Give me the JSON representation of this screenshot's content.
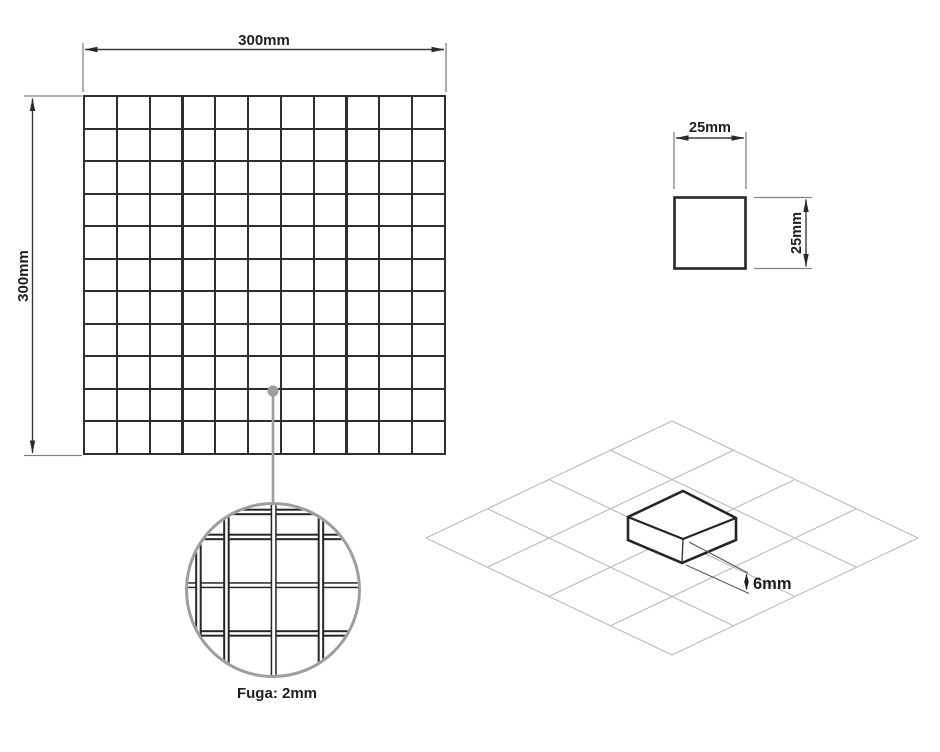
{
  "diagram": {
    "sheet": {
      "width_label": "300mm",
      "height_label": "300mm",
      "columns": 11,
      "rows": 11
    },
    "tile": {
      "width_label": "25mm",
      "height_label": "25mm"
    },
    "detail": {
      "grout_label": "Fuga: 2mm"
    },
    "iso": {
      "thickness_label": "6mm"
    }
  },
  "colors": {
    "background": "#ffffff",
    "tile_line": "#2e2e2e",
    "dimension_line": "#3a3a3a",
    "extension_line": "#828282",
    "leader_gray": "#9e9e9e",
    "iso_grid": "#bababa"
  }
}
